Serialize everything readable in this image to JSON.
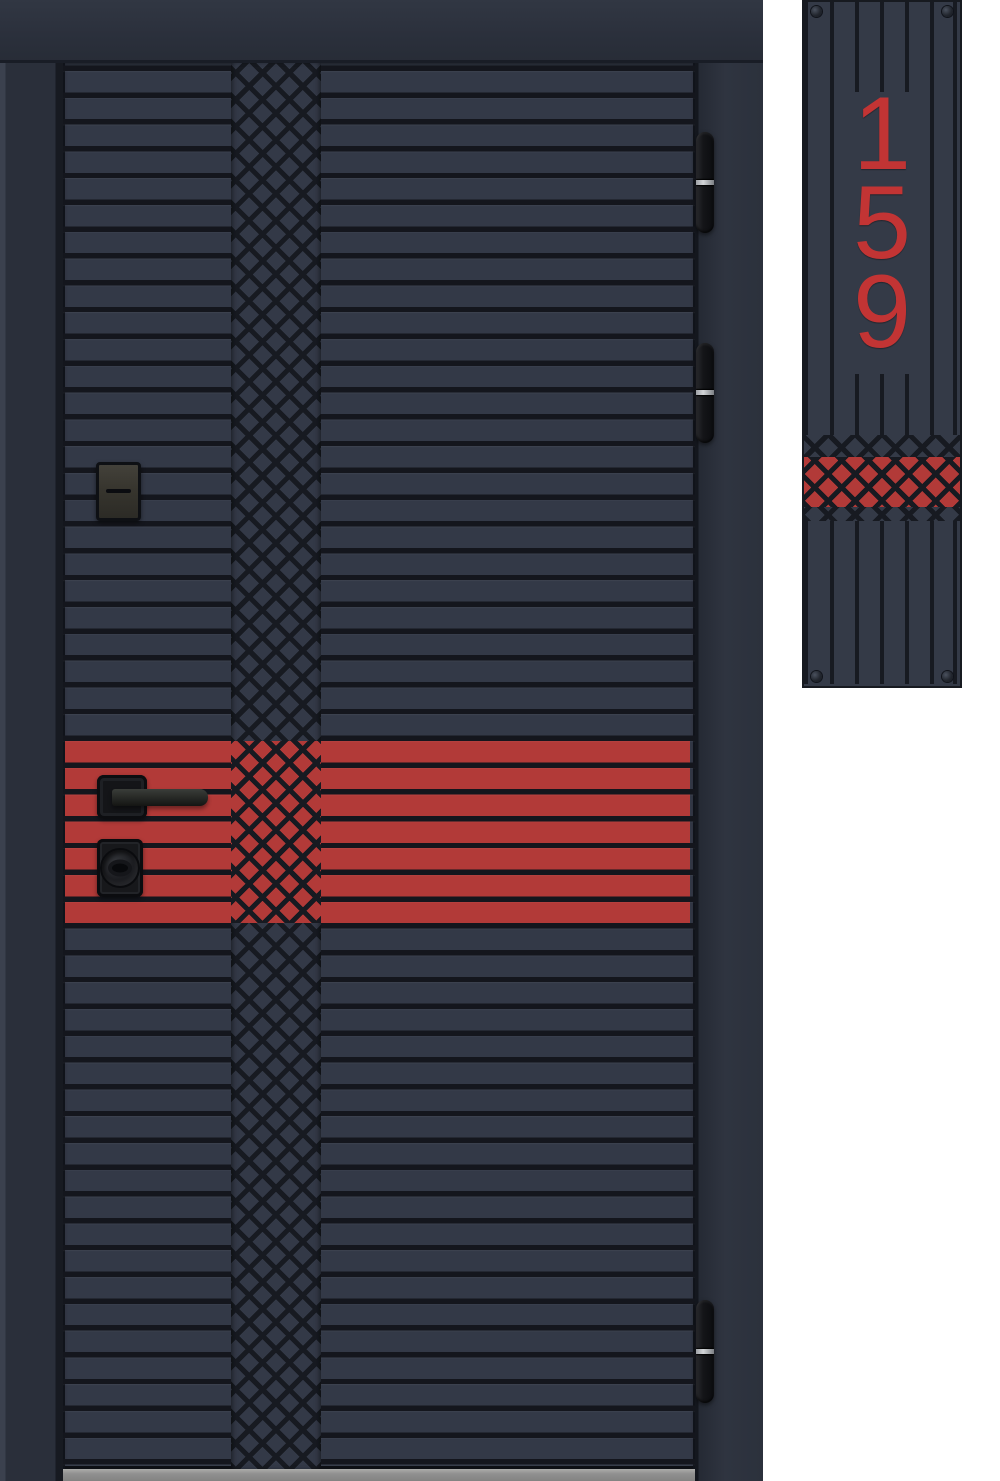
{
  "scene": {
    "type": "product-render",
    "subject": "entrance door with horizontal slats, diamond lattice column, red accent band and matching house-number plate",
    "background": "#ffffff"
  },
  "colors": {
    "background": "#ffffff",
    "frame": "#2b303c",
    "leaf": "#333947",
    "groove": "#14161d",
    "lattice_line": "#171a21",
    "accent_red": "#b23a38",
    "digit_red": "#c23434",
    "plate": "#343a47",
    "threshold": "#909090",
    "hinge_ring": "#d2d5d8"
  },
  "door": {
    "style": "horizontal-slat door with central diamond lattice column",
    "accent": "red slat band across middle with lattice overlay",
    "hinge_count": 3,
    "hinges": [
      "top",
      "middle",
      "bottom"
    ]
  },
  "hardware": {
    "handle": "black lever handle on square rose",
    "lock": "round cylinder knob on black escutcheon",
    "keyhole": "rectangular keyhole cover with horizontal slot"
  },
  "number_plate": {
    "number": "159",
    "digits": [
      "1",
      "5",
      "9"
    ],
    "screw_count": 4,
    "accent": "red diamond lattice band below digits"
  }
}
